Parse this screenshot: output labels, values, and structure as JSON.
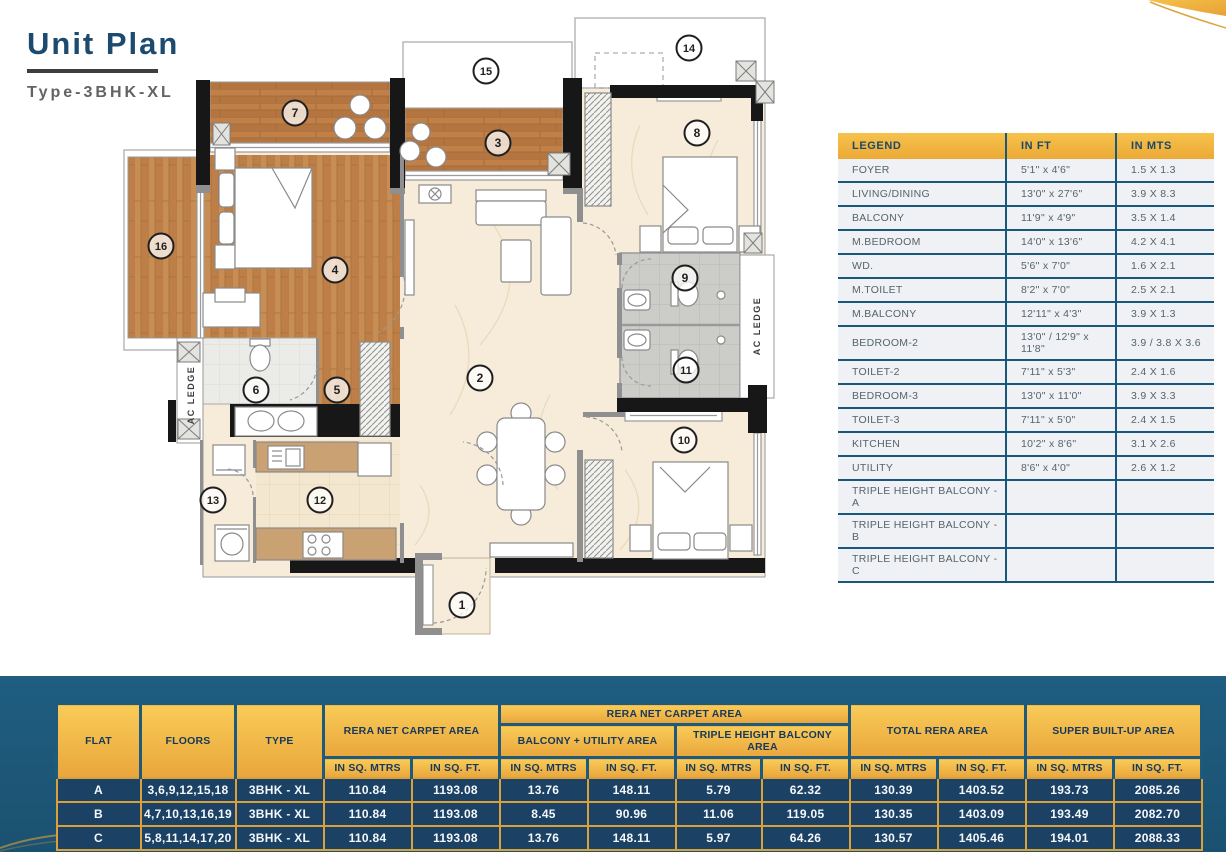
{
  "header": {
    "title": "Unit Plan",
    "subtitle": "Type-3BHK-XL"
  },
  "colors": {
    "accent_gold": "#e9a83c",
    "navy_row": "#1b4164",
    "teal_band": "#1d5a7c",
    "title_blue": "#1d4b70",
    "legend_header_gold": "#f0b43c"
  },
  "legend_table": {
    "columns": [
      "LEGEND",
      "IN FT",
      "IN MTS"
    ],
    "rows": [
      [
        "FOYER",
        "5'1\" x 4'6\"",
        "1.5 X 1.3"
      ],
      [
        "LIVING/DINING",
        "13'0\" x 27'6\"",
        "3.9 X 8.3"
      ],
      [
        "BALCONY",
        "11'9\" x 4'9\"",
        "3.5 X 1.4"
      ],
      [
        "M.BEDROOM",
        "14'0\" x 13'6\"",
        "4.2 X 4.1"
      ],
      [
        "WD.",
        "5'6\" x 7'0\"",
        "1.6 X 2.1"
      ],
      [
        "M.TOILET",
        "8'2\" x 7'0\"",
        "2.5 X 2.1"
      ],
      [
        "M.BALCONY",
        "12'11\" x 4'3\"",
        "3.9 X 1.3"
      ],
      [
        "BEDROOM-2",
        "13'0\" / 12'9\" x 11'8\"",
        "3.9 / 3.8 X 3.6"
      ],
      [
        "TOILET-2",
        "7'11\" x 5'3\"",
        "2.4 X 1.6"
      ],
      [
        "BEDROOM-3",
        "13'0\" x 11'0\"",
        "3.9 X 3.3"
      ],
      [
        "TOILET-3",
        "7'11\" x 5'0\"",
        "2.4 X 1.5"
      ],
      [
        "KITCHEN",
        "10'2\" x 8'6\"",
        "3.1 X 2.6"
      ],
      [
        "UTILITY",
        "8'6\" x 4'0\"",
        "2.6 X 1.2"
      ],
      [
        "TRIPLE HEIGHT BALCONY - A",
        "",
        ""
      ],
      [
        "TRIPLE HEIGHT BALCONY - B",
        "",
        ""
      ],
      [
        "TRIPLE HEIGHT BALCONY - C",
        "",
        ""
      ]
    ]
  },
  "area_table": {
    "headers": {
      "flat": "FLAT",
      "floors": "FLOORS",
      "type": "TYPE",
      "rera_net_carpet": "RERA NET CARPET AREA",
      "rera_net_carpet_group": "RERA NET CARPET AREA",
      "balcony_utility": "BALCONY + UTILITY AREA",
      "triple_height_balcony": "TRIPLE HEIGHT BALCONY AREA",
      "total_rera": "TOTAL RERA AREA",
      "super_built_up": "SUPER BUILT-UP AREA",
      "in_sq_mtrs": "IN SQ. MTRS",
      "in_sq_ft": "IN SQ. FT."
    },
    "rows": [
      {
        "flat": "A",
        "floors": "3,6,9,12,15,18",
        "type": "3BHK - XL",
        "values": [
          "110.84",
          "1193.08",
          "13.76",
          "148.11",
          "5.79",
          "62.32",
          "130.39",
          "1403.52",
          "193.73",
          "2085.26"
        ]
      },
      {
        "flat": "B",
        "floors": "4,7,10,13,16,19",
        "type": "3BHK - XL",
        "values": [
          "110.84",
          "1193.08",
          "8.45",
          "90.96",
          "11.06",
          "119.05",
          "130.35",
          "1403.09",
          "193.49",
          "2082.70"
        ]
      },
      {
        "flat": "C",
        "floors": "5,8,11,14,17,20",
        "type": "3BHK - XL",
        "values": [
          "110.84",
          "1193.08",
          "13.76",
          "148.11",
          "5.97",
          "64.26",
          "130.57",
          "1405.46",
          "194.01",
          "2088.33"
        ]
      }
    ]
  },
  "floor_plan": {
    "ac_ledge_label": "AC LEDGE",
    "markers": [
      {
        "num": "1",
        "room": "foyer"
      },
      {
        "num": "2",
        "room": "living-dining"
      },
      {
        "num": "3",
        "room": "balcony"
      },
      {
        "num": "4",
        "room": "m-bedroom"
      },
      {
        "num": "5",
        "room": "wd"
      },
      {
        "num": "6",
        "room": "m-toilet"
      },
      {
        "num": "7",
        "room": "m-balcony"
      },
      {
        "num": "8",
        "room": "bedroom-2"
      },
      {
        "num": "9",
        "room": "toilet-2"
      },
      {
        "num": "10",
        "room": "bedroom-3"
      },
      {
        "num": "11",
        "room": "toilet-3"
      },
      {
        "num": "12",
        "room": "kitchen"
      },
      {
        "num": "13",
        "room": "utility"
      },
      {
        "num": "14",
        "room": "triple-height-balcony"
      },
      {
        "num": "15",
        "room": "triple-height-balcony"
      },
      {
        "num": "16",
        "room": "triple-height-balcony"
      }
    ]
  }
}
